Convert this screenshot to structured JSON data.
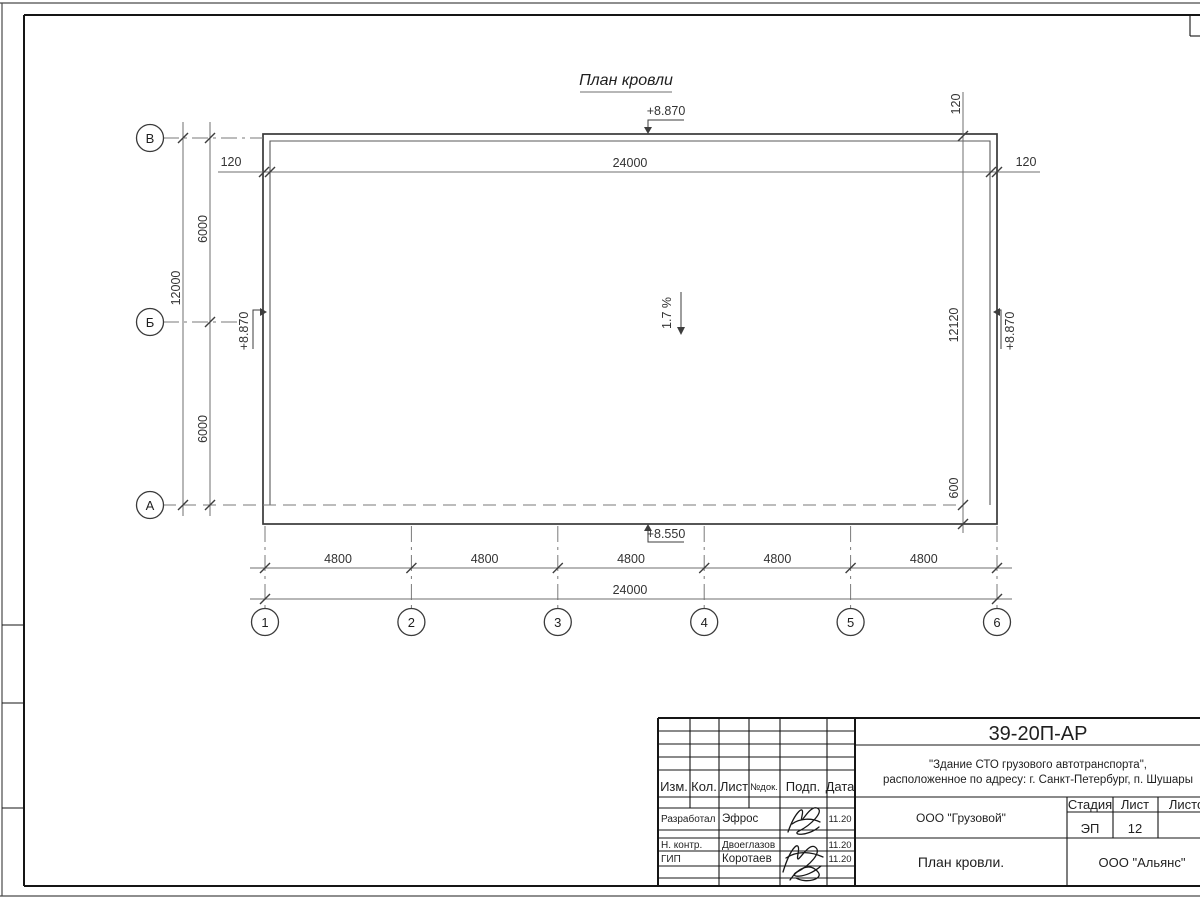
{
  "sheet": {
    "title": "План кровли",
    "slope": "1.7 %",
    "axes_rows": [
      "В",
      "Б",
      "А"
    ],
    "axes_cols": [
      "1",
      "2",
      "3",
      "4",
      "5",
      "6"
    ],
    "dims": {
      "top_total": "24000",
      "bottom_total": "24000",
      "offset_left": "120",
      "offset_right": "120",
      "offset_top_right": "120",
      "left_total": "12000",
      "left_seg_1": "6000",
      "left_seg_2": "6000",
      "right_total": "12120",
      "right_overhang": "600",
      "bottom_segs": [
        "4800",
        "4800",
        "4800",
        "4800",
        "4800"
      ]
    },
    "elevations": {
      "top": "+8.870",
      "left": "+8.870",
      "right": "+8.870",
      "bottom": "+8.550"
    }
  },
  "title_block": {
    "doc_number": "39-20П-АР",
    "project_line1": "\"Здание СТО грузового автотранспорта\",",
    "project_line2": "расположенное по адресу: г. Санкт-Петербург, п. Шушары",
    "col_izm": "Изм.",
    "col_kol": "Кол.",
    "col_list": "Лист",
    "col_ndok": "№док.",
    "col_podp": "Подп.",
    "col_data": "Дата",
    "rows": [
      {
        "role": "Разработал",
        "name": "Эфрос",
        "date": "11.20"
      },
      {
        "role": "Н. контр.",
        "name": "Двоеглазов",
        "date": "11.20"
      },
      {
        "role": "ГИП",
        "name": "Коротаев",
        "date": "11.20"
      }
    ],
    "organization": "ООО \"Грузовой\"",
    "stage_label": "Стадия",
    "sheet_label": "Лист",
    "sheets_label": "Листов",
    "stage_value": "ЭП",
    "sheet_value": "12",
    "sheet_name": "План кровли.",
    "company": "ООО \"Альянс\""
  },
  "colors": {
    "line": "#383838",
    "dim": "#6f6f6f",
    "accent": "#151515"
  }
}
